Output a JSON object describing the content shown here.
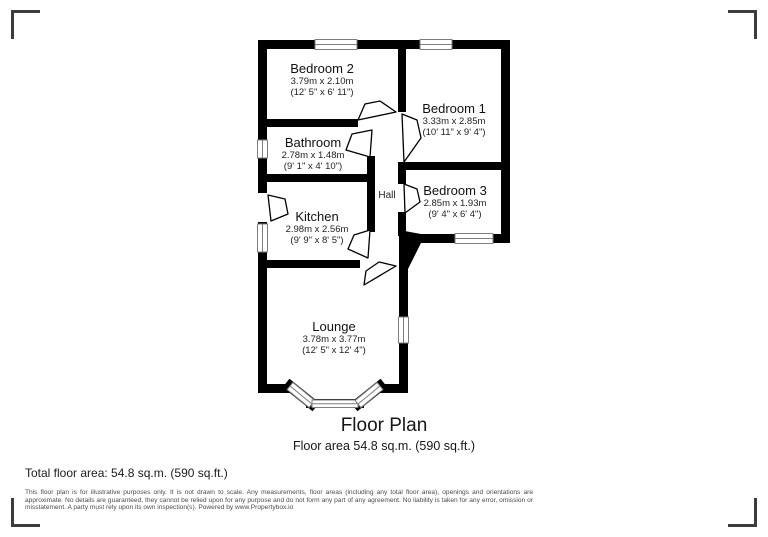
{
  "frame": {
    "corner_marks": [
      "top-left",
      "top-right",
      "bottom-left",
      "bottom-right"
    ]
  },
  "plan": {
    "title": "Floor Plan",
    "subtitle": "Floor area 54.8 sq.m. (590 sq.ft.)",
    "rooms": [
      {
        "name": "Bedroom 2",
        "metric": "3.79m x 2.10m",
        "imperial": "(12' 5\" x 6' 11\")"
      },
      {
        "name": "Bedroom 1",
        "metric": "3.33m x 2.85m",
        "imperial": "(10' 11\" x 9' 4\")"
      },
      {
        "name": "Bathroom",
        "metric": "2.78m x 1.48m",
        "imperial": "(9' 1\" x 4' 10\")"
      },
      {
        "name": "Bedroom 3",
        "metric": "2.85m x 1.93m",
        "imperial": "(9' 4\" x 6' 4\")"
      },
      {
        "name": "Hall",
        "metric": "",
        "imperial": ""
      },
      {
        "name": "Kitchen",
        "metric": "2.98m x 2.56m",
        "imperial": "(9' 9\" x 8' 5\")"
      },
      {
        "name": "Lounge",
        "metric": "3.78m x 3.77m",
        "imperial": "(12' 5\" x 12' 4\")"
      }
    ]
  },
  "footer": {
    "total_area": "Total floor area: 54.8 sq.m. (590 sq.ft.)",
    "disclaimer": "This floor plan is for illustrative purposes only. It is not drawn to scale. Any measurements, floor areas (including any total floor area), openings and orientations are approximate. No details are guaranteed, they cannot be relied upon for any purpose and do not form any part of any agreement. No liability is taken for any error, omission or misstatement. A party must rely upon its own inspection(s). Powered by www.Propertybox.io"
  },
  "colors": {
    "wall": "#000000",
    "window_line": "#7d7d7d",
    "text": "#1f1f1f",
    "muted_text": "#4a4a4a",
    "corner_mark": "#3c3c3c"
  }
}
